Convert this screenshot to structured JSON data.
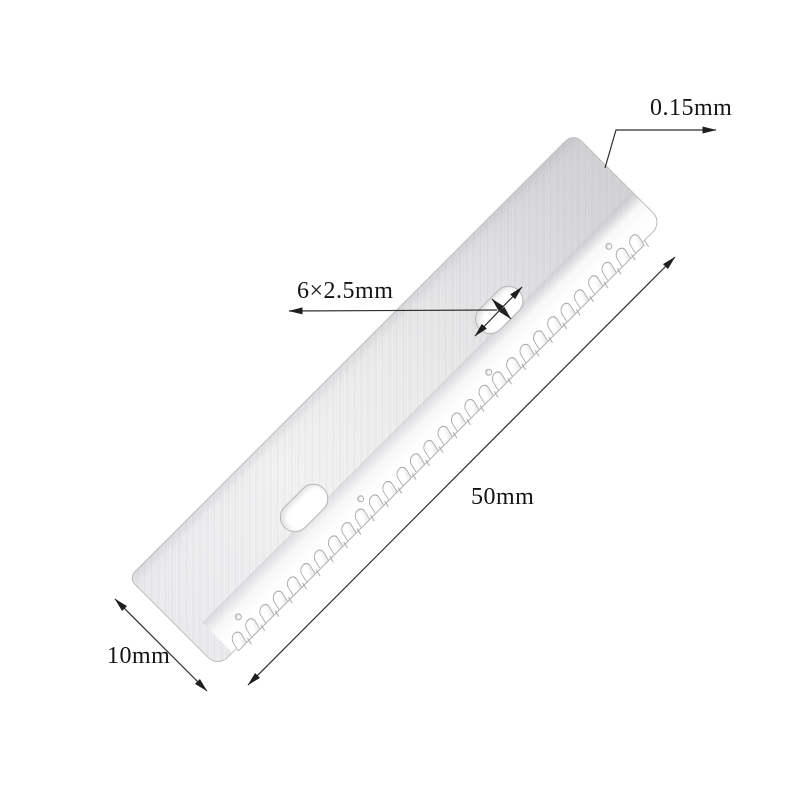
{
  "page": {
    "background": "#ffffff",
    "type": "product-dimension-diagram",
    "subject": "serrated craft razor blade"
  },
  "dimensions": {
    "thickness": "0.15mm",
    "slot": "6×2.5mm",
    "length": "50mm",
    "width": "10mm"
  },
  "blade": {
    "teeth_count": 30,
    "slot_count": 2,
    "hole_count": 4,
    "colors": {
      "body_light": "#f4f4f5",
      "body_dark": "#d4d4d6",
      "edge_outline": "#bcbcbe",
      "tooth_outline": "#a9a9ab",
      "bevel_white": "#ffffff"
    }
  },
  "annotation": {
    "line_color": "#2e2e2e",
    "arrow_color": "#1f1f1f",
    "text_color": "#141414"
  }
}
